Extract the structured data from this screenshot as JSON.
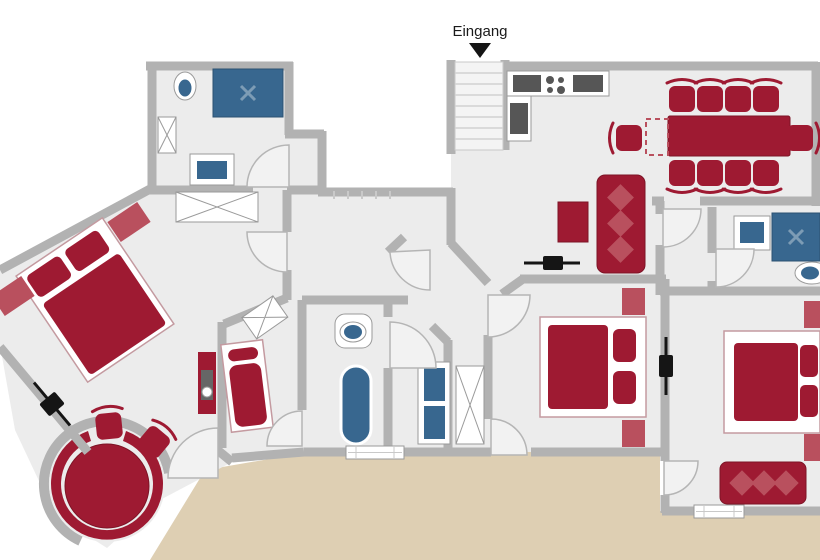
{
  "entrance": {
    "label": "Eingang"
  },
  "colors": {
    "wall": "#b2b2b2",
    "wall_light": "#c9c9c9",
    "floor": "#ececec",
    "stairs_floor": "#f4f4f4",
    "stair_line": "#d2d2d2",
    "red": "#9e1a32",
    "red_dark": "#7d1426",
    "red_light": "#b9505e",
    "blue": "#38678f",
    "blue_dark": "#2c5272",
    "blue_light": "#7d9cb5",
    "terrace": "#decfb3",
    "appliance": "#565656",
    "white": "#ffffff",
    "black": "#151515",
    "outline": "#9a9a9a",
    "door_fill": "#f2f2f2",
    "door_stroke": "#b5b5b5"
  },
  "stairs": {
    "visible_steps": 7
  },
  "inventory": {
    "entrance_area": [
      "staircase",
      "entrance-arrow"
    ],
    "kitchen": [
      "l-shaped-counter",
      "cooktop-4-burners",
      "counter-appliance",
      "oven"
    ],
    "dining_area": [
      "dining-table",
      "dashed-table-extension",
      "eight-chairs",
      "two-end-chairs"
    ],
    "living_area": [
      "three-seat-sofa",
      "coffee-table",
      "tv-marker"
    ],
    "bathroom_top_left": [
      "toilet",
      "shower",
      "shelf",
      "washbasin"
    ],
    "bedroom_left": [
      "double-bed",
      "two-nightstands",
      "wardrobe",
      "dresser-with-basin",
      "window-marker"
    ],
    "bay_alcove": [
      "round-table",
      "curved-bench",
      "two-chairs"
    ],
    "bedroom_small": [
      "single-bed",
      "tilted-shelf"
    ],
    "bathroom_middle": [
      "toilet",
      "bathtub"
    ],
    "utility_room": [
      "washer-dryer-stack",
      "shelf-cabinet"
    ],
    "bathroom_top_right": [
      "washbasin",
      "shower",
      "toilet"
    ],
    "bedroom_middle": [
      "double-bed",
      "two-nightstands",
      "tv-marker"
    ],
    "bedroom_right": [
      "double-bed",
      "two-nightstands",
      "three-seat-sofa"
    ],
    "hallway": [
      "coat-hooks"
    ],
    "windows": [
      "window-bottom-middle",
      "window-bottom-right"
    ]
  }
}
